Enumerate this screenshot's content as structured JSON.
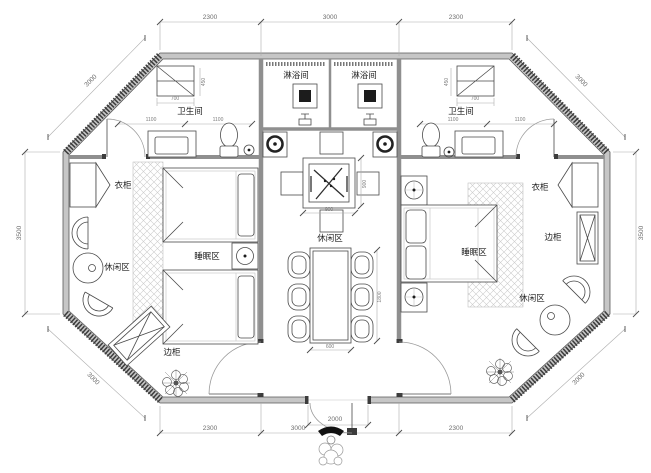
{
  "labels": {
    "shower_left": "淋浴间",
    "shower_right": "淋浴间",
    "bathroom_left": "卫生间",
    "bathroom_right": "卫生间",
    "wardrobe_left": "衣柜",
    "wardrobe_right": "衣柜",
    "leisure_left": "休闲区",
    "leisure_center": "休闲区",
    "leisure_right": "休闲区",
    "sleeping_left": "睡眠区",
    "sleeping_right": "睡眠区",
    "cabinet_left": "边柜",
    "cabinet_right": "边柜"
  },
  "dimensions": {
    "top": [
      "2300",
      "3000",
      "2300"
    ],
    "bottom": [
      "2300",
      "3000",
      "2300"
    ],
    "side_left": "3500",
    "side_right": "3500",
    "entrance": "2000",
    "diag_top_left": "3000",
    "diag_top_right": "3000",
    "diag_bottom_right": "3000",
    "diag_bottom_left": "3000",
    "closet_left": "700",
    "closet_right": "700",
    "closet_depth_left": "450",
    "closet_depth_right": "450",
    "bath_left": [
      "1100",
      "1100"
    ],
    "bath_right": [
      "1100",
      "1100"
    ],
    "tea_w": "900",
    "tea_h": "900",
    "dining_w": "600",
    "dining_l": "1800"
  },
  "colors": {
    "wall_fill": "#c6c6c6",
    "wall_dark": "#3c3c3c",
    "line": "#4a4a4a",
    "dim_text": "#6e6e6e",
    "rug_hatch": "#cccccc"
  }
}
